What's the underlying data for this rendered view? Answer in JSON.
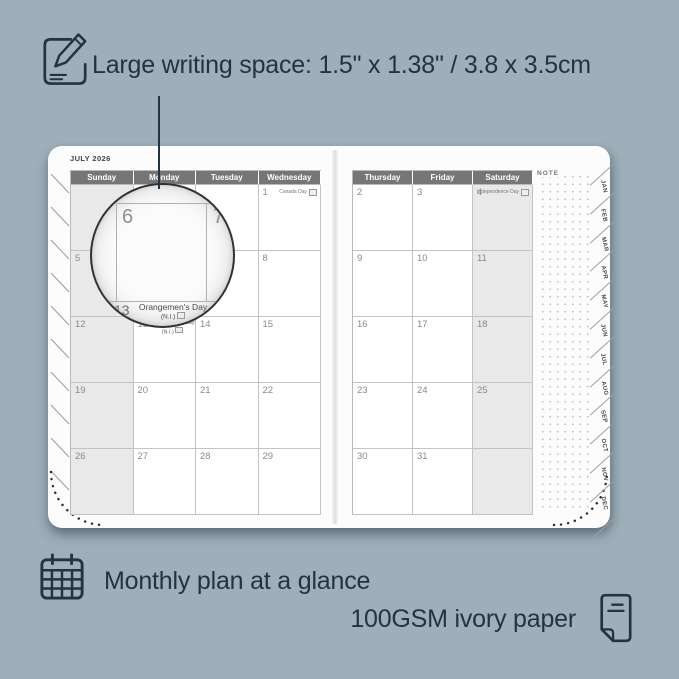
{
  "colors": {
    "background": "#9EAFBA",
    "ink": "#233440",
    "page": "#fcfcfd",
    "header_bg": "#767676",
    "shaded_cell": "#e9e9e9",
    "grid_line": "#c3c3c3"
  },
  "annotations": {
    "top": "Large writing space: 1.5\" x 1.38\" / 3.8 x 3.5cm",
    "bottom_left": "Monthly plan at a glance",
    "bottom_right": "100GSM ivory paper"
  },
  "calendar": {
    "month_title": "JULY 2026",
    "note_label": "NOTE",
    "left_page": {
      "headers": [
        "Sunday",
        "Monday",
        "Tuesday",
        "Wednesday"
      ],
      "shaded_col": 0,
      "weeks": [
        [
          "",
          "",
          "",
          {
            "day": "1",
            "holiday": "Canada Day",
            "flag": true
          }
        ],
        [
          "5",
          "6",
          "7",
          "8"
        ],
        [
          "12",
          {
            "day": "13",
            "holiday": "Orangemen's Day",
            "holiday2": "(N.I.)",
            "flag": true
          },
          "14",
          "15"
        ],
        [
          "19",
          "20",
          "21",
          "22"
        ],
        [
          "26",
          "27",
          "28",
          "29"
        ]
      ]
    },
    "right_page": {
      "headers": [
        "Thursday",
        "Friday",
        "Saturday"
      ],
      "shaded_col": 2,
      "weeks": [
        [
          "2",
          "3",
          {
            "day": "4",
            "holiday": "Independence Day",
            "flag": true
          }
        ],
        [
          "9",
          "10",
          "11"
        ],
        [
          "16",
          "17",
          "18"
        ],
        [
          "23",
          "24",
          "25"
        ],
        [
          "30",
          "31",
          ""
        ]
      ]
    },
    "tabs": [
      "JAN",
      "FEB",
      "MAR",
      "APR",
      "MAY",
      "JUN",
      "JUL",
      "AUG",
      "SEP",
      "OCT",
      "NOV",
      "DEC"
    ]
  },
  "magnifier": {
    "left_day": "6",
    "right_day": "7",
    "bottom_day": "13",
    "bottom_holiday": "Orangemen's Day",
    "bottom_region": "(N.I.)"
  }
}
